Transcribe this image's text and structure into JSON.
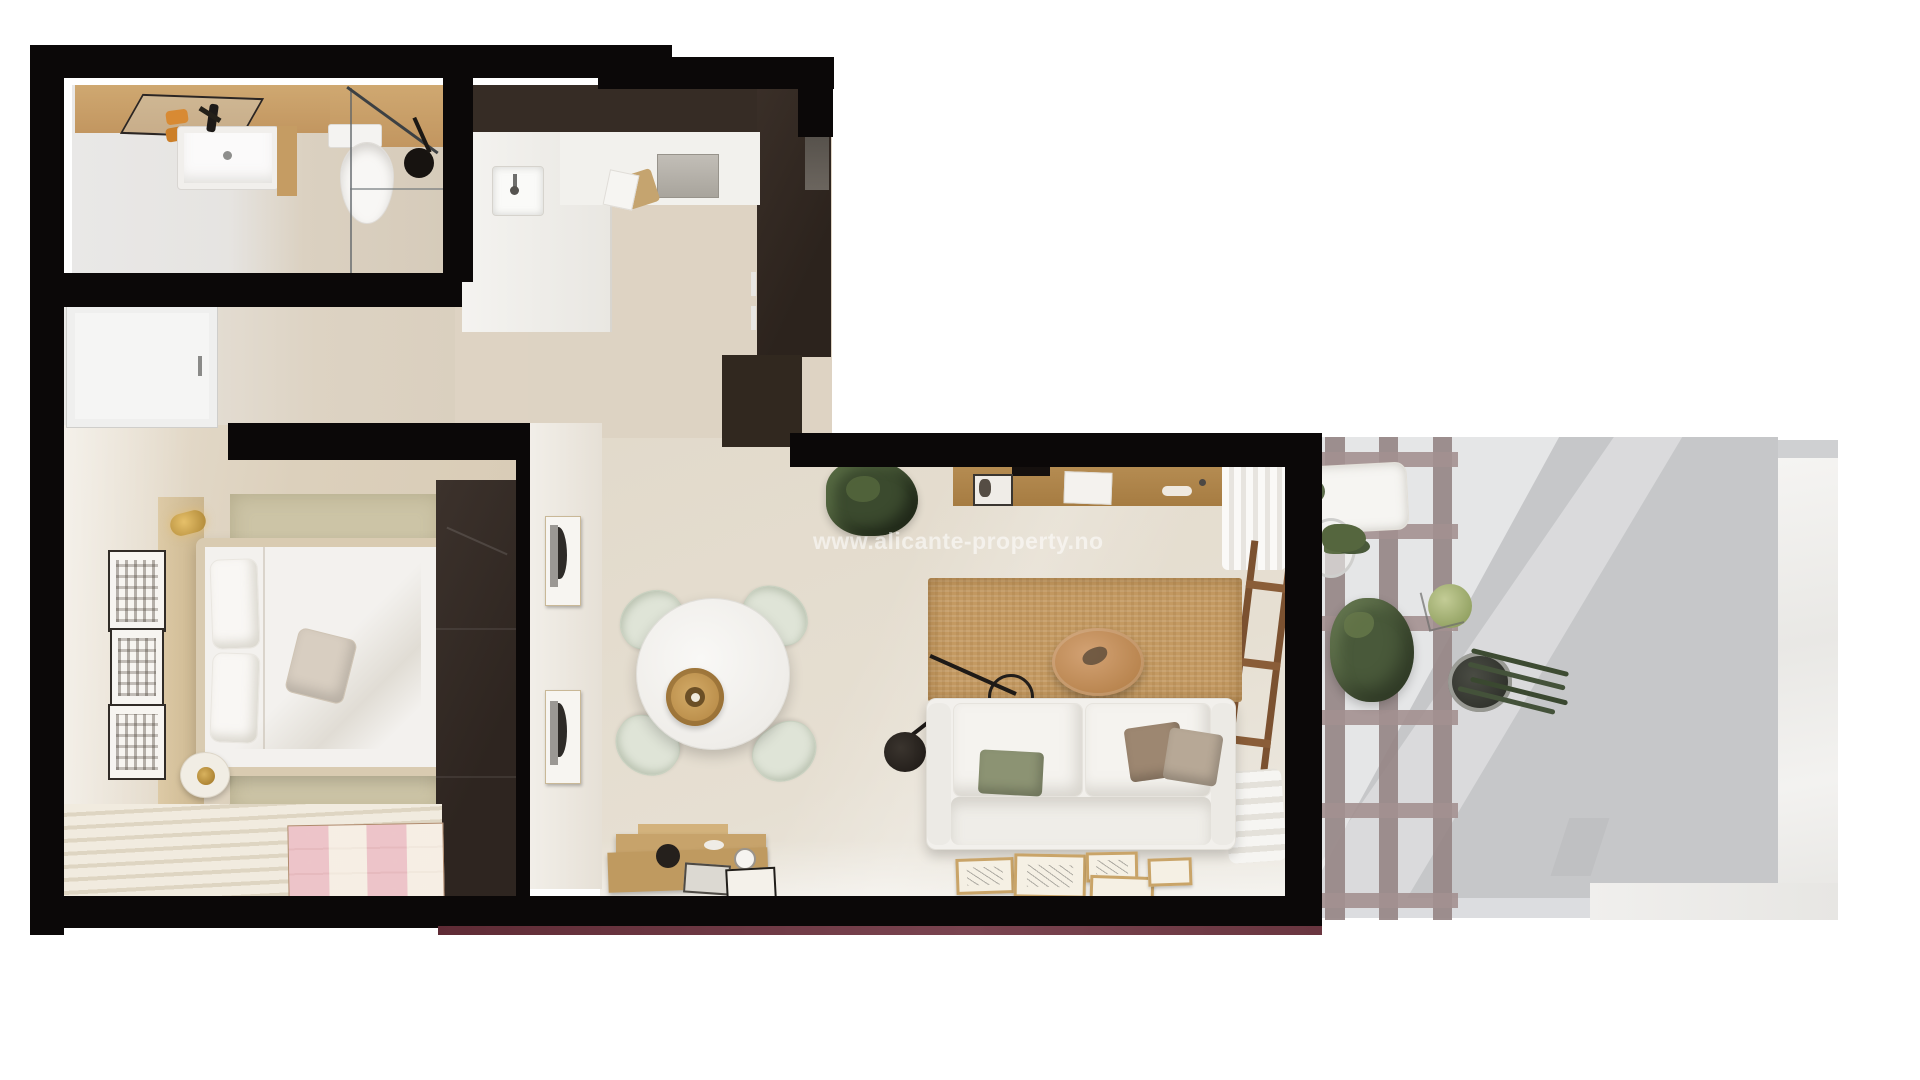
{
  "watermark": {
    "text": "www.alicante-property.no",
    "color": "#ffffff",
    "opacity": 0.55
  },
  "scene": {
    "type": "3d-apartment-floor-plan-top-view",
    "rooms": [
      {
        "name": "bathroom",
        "furniture": [
          "vanity-sink",
          "wall-mirror",
          "orange-towels",
          "toilet",
          "glass-shower",
          "shower-head",
          "wood-counter"
        ]
      },
      {
        "name": "hallway",
        "furniture": [
          "entry-door"
        ]
      },
      {
        "name": "kitchen",
        "furniture": [
          "dark-upper-cabinets",
          "tall-dark-cabinets",
          "white-counter",
          "kitchen-sink",
          "cooktop",
          "cutting-board",
          "oven"
        ]
      },
      {
        "name": "bedroom",
        "furniture": [
          "double-bed",
          "pillows",
          "throw-pillow",
          "headboard-panel",
          "wall-sconce",
          "bedside-lamp",
          "three-wall-frames",
          "dark-wardrobe",
          "olive-carpet",
          "striped-rug",
          "pink-check-runner"
        ]
      },
      {
        "name": "living-dining-room",
        "furniture": [
          "round-dining-table",
          "four-dining-chairs",
          "rattan-pendant-lamp",
          "white-sofa",
          "green-cushion",
          "brown-cushions",
          "jute-rug",
          "round-coffee-table",
          "arc-floor-lamp",
          "wall-shelf",
          "tv",
          "curtains",
          "wood-ladder-shelf",
          "blanket-pile",
          "potted-plant",
          "wood-sideboard",
          "leaning-floor-frames",
          "two-wall-artworks"
        ]
      },
      {
        "name": "terrace",
        "furniture": [
          "pergola-grid",
          "white-lounger",
          "wire-basket-plant",
          "large-green-plant",
          "moss-ball-plant",
          "cactus-pot",
          "marble-border"
        ]
      }
    ]
  },
  "palette": {
    "wall_black": "#0b0808",
    "floor_beige": "#ddd3c3",
    "kitchen_cabinets": "#362c25",
    "wardrobe_brown": "#332a24",
    "wood_shelf": "#b58c52",
    "jute_rug": "#c49a62",
    "sage_chair": "#dfe4d7",
    "green_pillow": "#8c9373",
    "terrace_floor": "#c6c7c9",
    "pergola_mauve": "#9a8989",
    "marble_white": "#f4f3f1",
    "maroon_edge": "#62303a",
    "plant_green": "#49593a",
    "towel_orange": "#d88a33"
  }
}
